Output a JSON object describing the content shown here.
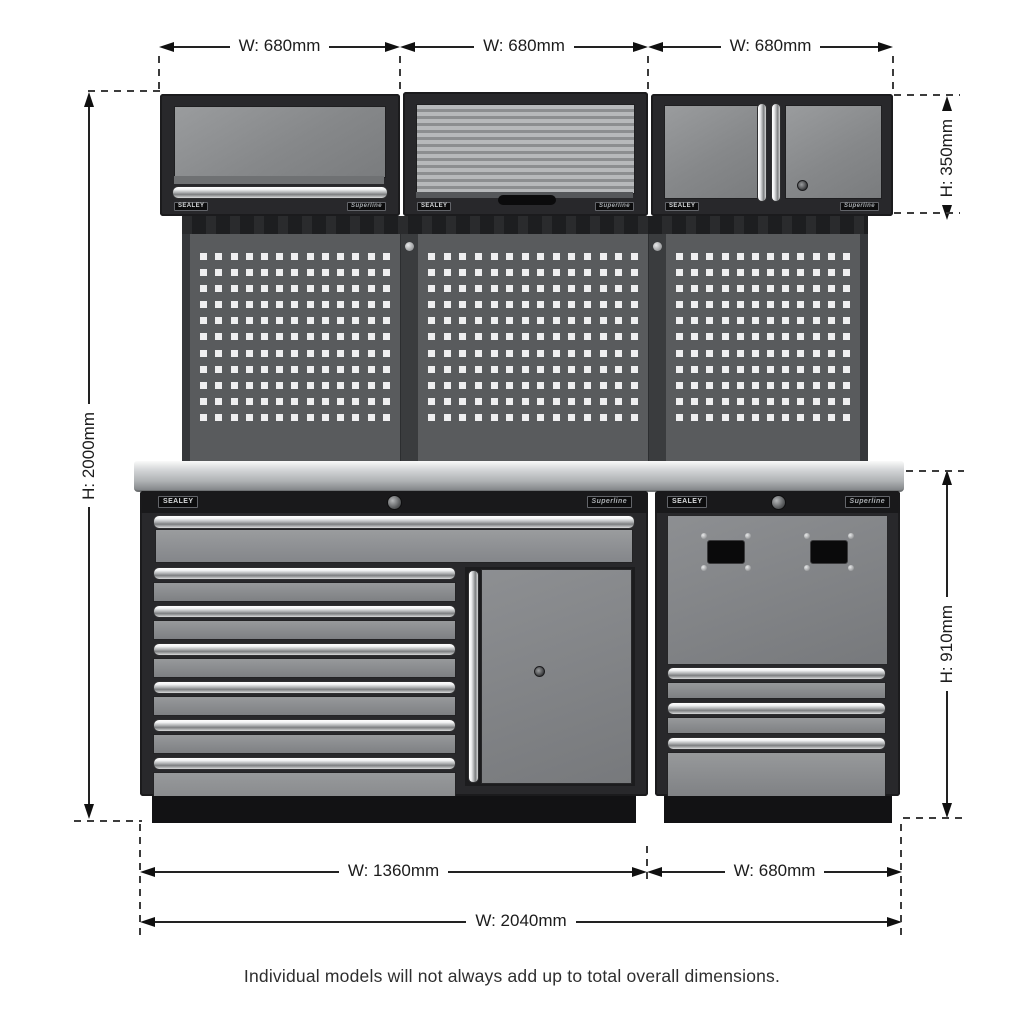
{
  "dims": {
    "top": [
      "W: 680mm",
      "W: 680mm",
      "W: 680mm"
    ],
    "left": "H: 2000mm",
    "right_top": "H: 350mm",
    "right_bottom": "H: 910mm",
    "bottom_left": "W: 1360mm",
    "bottom_right": "W: 680mm",
    "overall": "W: 2040mm"
  },
  "caption": "Individual models will not always add up to total overall dimensions.",
  "product": {
    "brand": "SEALEY",
    "series": "Superline"
  },
  "colors": {
    "dimension_line": "#222222",
    "cabinet_frame": "#28282b",
    "panel_gray": "#86888a",
    "pegboard": "#595b5d",
    "worktop_steel": "#c6c8ca",
    "background": "#ffffff"
  }
}
